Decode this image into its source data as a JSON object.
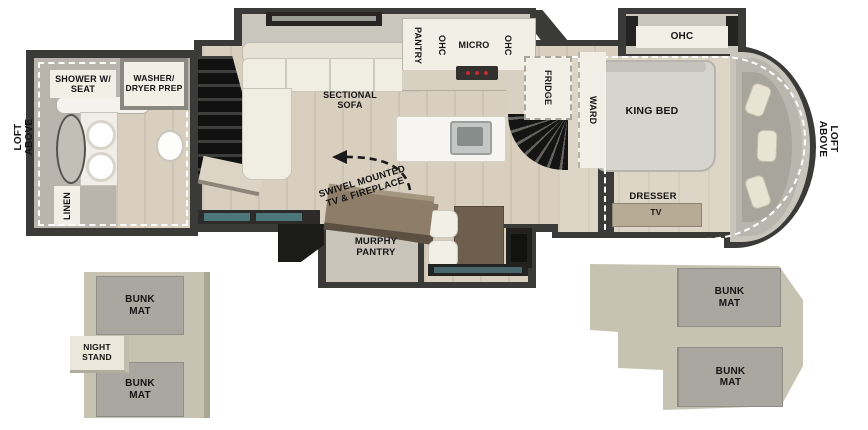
{
  "exterior": {
    "loft_above_left": "LOFT ABOVE",
    "loft_above_right": "LOFT ABOVE"
  },
  "bathroom": {
    "shower": "SHOWER W/ SEAT",
    "washer_dryer": "WASHER/ DRYER PREP",
    "linen": "LINEN"
  },
  "living": {
    "sectional_sofa": "SECTIONAL SOFA",
    "swivel_tv": "SWIVEL MOUNTED TV & FIREPLACE",
    "murphy_pantry": "MURPHY PANTRY"
  },
  "kitchen": {
    "pantry": "PANTRY",
    "ohc_left": "OHC",
    "micro": "MICRO",
    "ohc_right": "OHC",
    "fridge": "FRIDGE"
  },
  "bedroom": {
    "ward": "WARD",
    "king_bed": "KING BED",
    "ohc": "OHC",
    "dresser": "DRESSER",
    "tv": "TV"
  },
  "bunkhouse_left": {
    "mat_top": "BUNK MAT",
    "night_stand": "NIGHT STAND",
    "mat_bottom": "BUNK MAT"
  },
  "bunkhouse_right": {
    "mat_top": "BUNK MAT",
    "mat_bottom": "BUNK MAT"
  },
  "colors": {
    "wall_dark": "#3a3a38",
    "floor_wood": "#d8cfbf",
    "bath_tile": "#b9b5ad",
    "label_cream": "#f2efe6",
    "bunk_mat_gray": "#a9a79f",
    "bunk_platform": "#c7c3b3",
    "stairs_black": "#161614",
    "table_brown": "#6e5e4e",
    "window_teal": "#4d767b",
    "bed_gray": "#d6d4ce",
    "stove_red": "#c22a2e"
  }
}
